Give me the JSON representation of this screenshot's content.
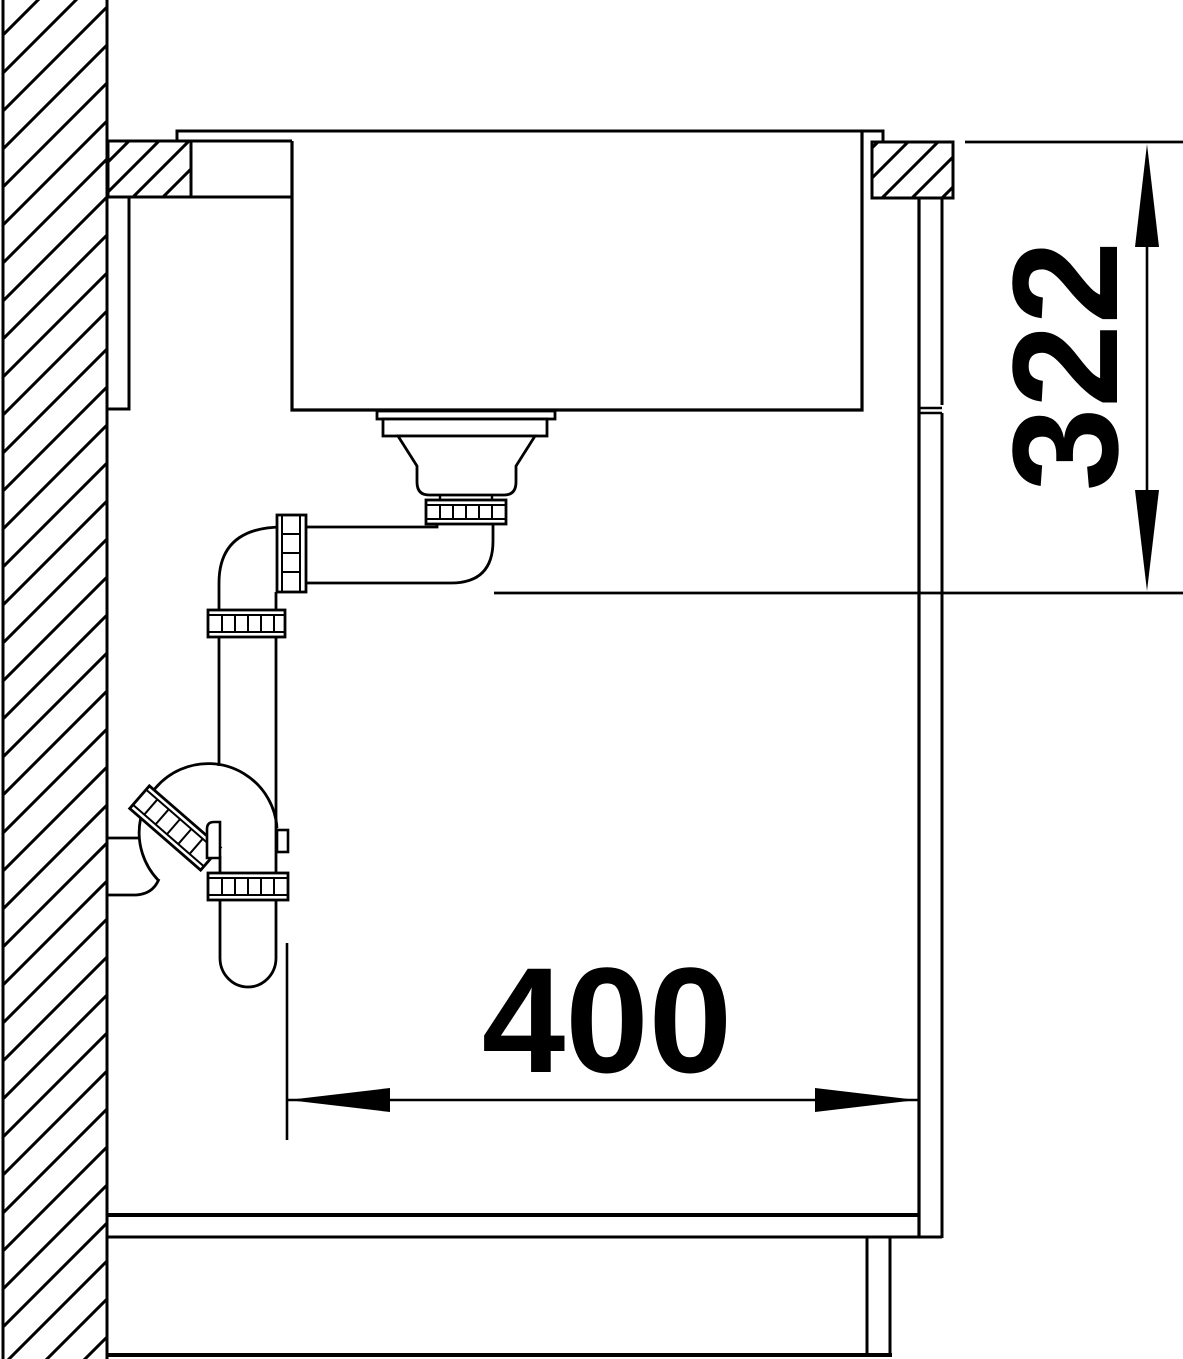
{
  "drawing": {
    "type": "technical-installation-cross-section",
    "background": "#ffffff",
    "line_color": "#000000",
    "dimensions": {
      "vertical": {
        "label": "322"
      },
      "horizontal": {
        "label": "400"
      }
    }
  }
}
